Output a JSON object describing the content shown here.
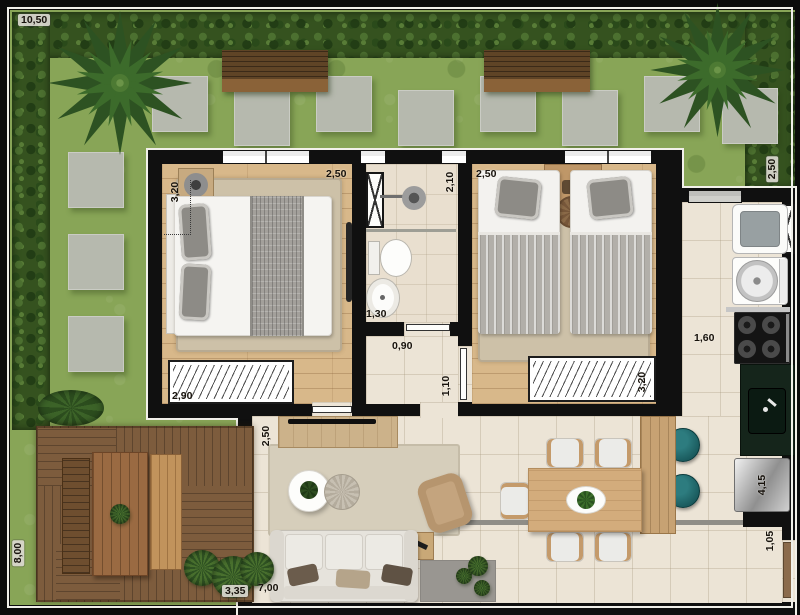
{
  "plan": {
    "labels": {
      "garden_width": "10,50",
      "bedroom1_depth": "3,20",
      "bedroom1_width": "2,50",
      "bedroom1_wardrobe": "2,90",
      "bathroom_depth": "2,10",
      "bathroom_width": "1,30",
      "hall_width": "0,90",
      "hall_length": "1,10",
      "bedroom2_width": "2,50",
      "bedroom2_wardrobe": "3,20",
      "kitchen_width": "1,60",
      "kitchen_run": "4,15",
      "entry_width": "1,05",
      "side_garden_depth": "2,50",
      "living_tv_wall": "2,50",
      "living_width": "7,00",
      "deck_depth": "8,00",
      "deck_width": "3,35"
    },
    "colors": {
      "grass": "#88a557",
      "hedge": "#35521f",
      "wall": "#101010",
      "wood_floor": "#d8b88a",
      "tile_floor": "#ece4d6",
      "deck": "#7d5c3d",
      "counter": "#15251b",
      "stool_teal": "#19595c",
      "paver": "#b6b9ae"
    }
  }
}
